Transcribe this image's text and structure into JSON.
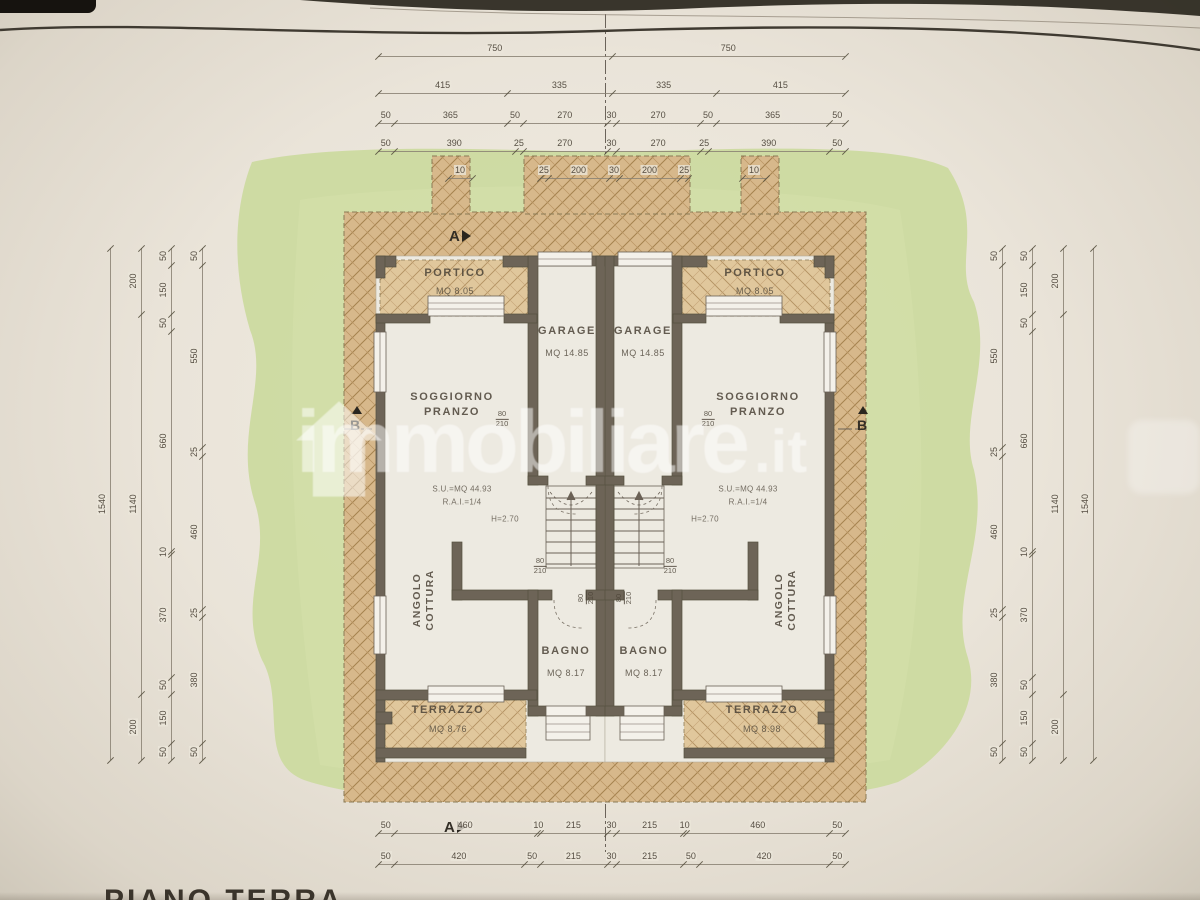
{
  "sheet": {
    "bottom_title": "PIANO TERRA"
  },
  "watermark": {
    "brand": "immobiliare",
    "tld": ".it",
    "logo": "house-logo"
  },
  "markers": {
    "section_a": "A",
    "section_b": "B"
  },
  "door_label": {
    "width": "80",
    "height": "210"
  },
  "rooms": {
    "left": {
      "portico_name": "PORTICO",
      "portico_area": "MQ 8.05",
      "garage_name": "GARAGE",
      "garage_area": "MQ 14.85",
      "soggiorno_line1": "SOGGIORNO",
      "soggiorno_line2": "PRANZO",
      "su": "S.U.=MQ 44.93",
      "rai": "R.A.I.=1/4",
      "height": "H=2.70",
      "angolo_line1": "ANGOLO",
      "angolo_line2": "COTTURA",
      "bagno_name": "BAGNO",
      "bagno_area": "MQ 8.17",
      "terrazzo_name": "TERRAZZO",
      "terrazzo_area": "MQ 8.76"
    },
    "right": {
      "portico_name": "PORTICO",
      "portico_area": "MQ 8.05",
      "garage_name": "GARAGE",
      "garage_area": "MQ 14.85",
      "soggiorno_line1": "SOGGIORNO",
      "soggiorno_line2": "PRANZO",
      "su": "S.U.=MQ 44.93",
      "rai": "R.A.I.=1/4",
      "height": "H=2.70",
      "angolo_line1": "ANGOLO",
      "angolo_line2": "COTTURA",
      "bagno_name": "BAGNO",
      "bagno_area": "MQ 8.17",
      "terrazzo_name": "TERRAZZO",
      "terrazzo_area": "MQ 8.98"
    }
  },
  "dims": {
    "top": [
      [
        "750",
        "750"
      ],
      [
        "415",
        "335",
        "335",
        "415"
      ],
      [
        "50",
        "365",
        "50",
        "270",
        "30",
        "270",
        "50",
        "365",
        "50"
      ],
      [
        "50",
        "390",
        "25",
        "270",
        "30",
        "270",
        "25",
        "390",
        "50"
      ]
    ],
    "top5_left": [
      "10"
    ],
    "top5_center": [
      "25",
      "200",
      "30",
      "200",
      "25"
    ],
    "top5_right": [
      "10"
    ],
    "bottom": [
      [
        "50",
        "460",
        "10",
        "215",
        "30",
        "215",
        "10",
        "460",
        "50"
      ],
      [
        "50",
        "420",
        "50",
        "215",
        "30",
        "215",
        "50",
        "420",
        "50"
      ]
    ],
    "left_cols": [
      [
        "1540"
      ],
      [
        "200",
        "1140",
        "200"
      ],
      [
        "50",
        "150",
        "50",
        "660",
        "10",
        "370",
        "50",
        "150",
        "50"
      ],
      [
        "50",
        "550",
        "25",
        "460",
        "25",
        "380",
        "50"
      ]
    ],
    "right_cols": [
      [
        "50",
        "550",
        "25",
        "460",
        "25",
        "380",
        "50"
      ],
      [
        "50",
        "150",
        "50",
        "660",
        "10",
        "370",
        "50",
        "150",
        "50"
      ],
      [
        "200",
        "1140",
        "200"
      ],
      [
        "1540"
      ]
    ]
  }
}
